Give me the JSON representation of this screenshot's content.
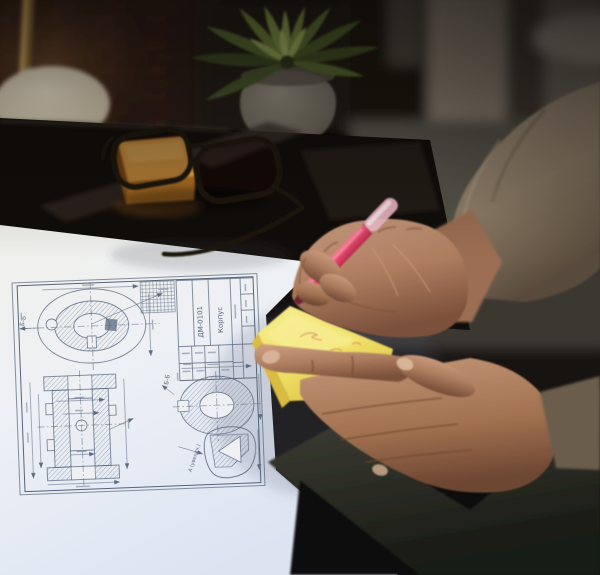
{
  "scene": {
    "objects": [
      "brick-wall",
      "desk-lamp",
      "succulent-plant",
      "concrete-pot",
      "glass-desk",
      "orange-sticky-pad",
      "black-eyeglasses",
      "technical-drawing-paper",
      "pink-marker-pen",
      "yellow-sticky-note",
      "writing-hand",
      "holding-hand",
      "beige-sweater-sleeve",
      "dark-clothing"
    ]
  },
  "drawing": {
    "section_label_top": "Б-Б",
    "section_label_ring": "Б-Б",
    "detail_label": "А (увелич.)",
    "title_code": "ДМ-0101",
    "title_part": "Корпус"
  },
  "colors": {
    "ink": "#56647a",
    "paperLight": "#f2f2ee",
    "paperBlue": "#dde4f0",
    "skin": "#b5886a",
    "skinShadow": "#7c513b",
    "sleeve": "#9d8c77",
    "noteYellow": "#f0e06a",
    "penPink": "#e0436a",
    "penCap": "#f2bcc8",
    "penTip": "#6e2130",
    "orangePad": "#e7a23f",
    "potGray": "#8d8678",
    "leafGreen": "#62732f",
    "tableDark": "#17120e",
    "clothing": "#34352b",
    "brick": "#402a20",
    "lampBase": "#e7dcc5",
    "lampPole": "#b98f4f",
    "glassesBlack": "#1a130d",
    "scribble": "#c0504d"
  }
}
